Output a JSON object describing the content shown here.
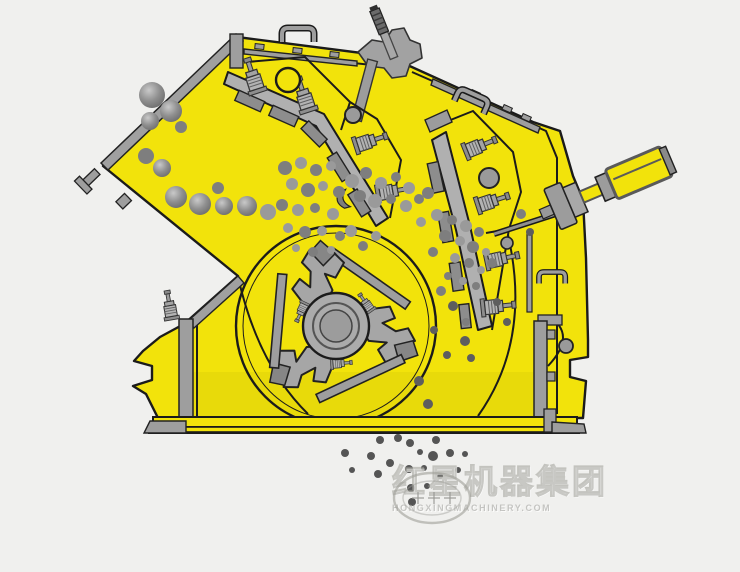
{
  "meta": {
    "alt": "Cutaway working-principle diagram of an impact crusher: rock is fed from the upper-left chute, struck by a three-hammer rotor, bounced against two spring-loaded apron plates, and discharged as crushed product below the base",
    "background": "#f0f0ee"
  },
  "colors": {
    "body_yellow": "#f2e30b",
    "outline_black": "#1b1b1b",
    "steel_gray": "#a6a6a6",
    "steel_dark": "#8a8a8a",
    "steel_light": "#c6c6c6",
    "rock_palette": [
      "#9a9a9a",
      "#7e7e7e",
      "#5e5e5e"
    ],
    "product_dot": "#555555",
    "watermark_gray": "#9e9e98"
  },
  "watermark": {
    "logo": "oval-globe-logo",
    "brand_cn": "红星机器集团",
    "brand_en": "HONGXINGMACHINERY.COM"
  },
  "figure": {
    "rocks": {
      "feed": [
        [
          152,
          95,
          13,
          0
        ],
        [
          171,
          111,
          11,
          1
        ],
        [
          150,
          121,
          9,
          0
        ],
        [
          146,
          156,
          8,
          1
        ],
        [
          162,
          168,
          9,
          0
        ],
        [
          181,
          127,
          6,
          1
        ],
        [
          176,
          197,
          11,
          0
        ],
        [
          200,
          204,
          11,
          1
        ],
        [
          224,
          206,
          9,
          0
        ],
        [
          247,
          206,
          10,
          1
        ],
        [
          268,
          212,
          8,
          0
        ],
        [
          218,
          188,
          6,
          1
        ]
      ],
      "shower": [
        [
          285,
          168,
          7,
          1
        ],
        [
          301,
          163,
          6,
          0
        ],
        [
          316,
          170,
          6,
          1
        ],
        [
          331,
          166,
          5,
          0
        ],
        [
          292,
          184,
          6,
          0
        ],
        [
          308,
          190,
          7,
          1
        ],
        [
          323,
          186,
          5,
          0
        ],
        [
          339,
          192,
          6,
          1
        ],
        [
          352,
          181,
          7,
          0
        ],
        [
          366,
          173,
          6,
          1
        ],
        [
          381,
          183,
          6,
          0
        ],
        [
          396,
          177,
          5,
          1
        ],
        [
          409,
          188,
          6,
          0
        ],
        [
          282,
          205,
          6,
          1
        ],
        [
          298,
          210,
          6,
          0
        ],
        [
          315,
          208,
          5,
          1
        ],
        [
          333,
          214,
          6,
          0
        ],
        [
          288,
          228,
          5,
          0
        ],
        [
          305,
          232,
          6,
          1
        ],
        [
          322,
          231,
          5,
          0
        ],
        [
          340,
          236,
          5,
          1
        ],
        [
          296,
          248,
          4,
          0
        ],
        [
          313,
          252,
          5,
          1
        ],
        [
          331,
          250,
          4,
          0
        ],
        [
          360,
          196,
          6,
          1
        ],
        [
          375,
          201,
          7,
          0
        ],
        [
          391,
          199,
          5,
          1
        ],
        [
          406,
          206,
          6,
          0
        ],
        [
          419,
          199,
          5,
          1
        ],
        [
          437,
          215,
          6,
          0
        ],
        [
          452,
          220,
          5,
          1
        ],
        [
          466,
          226,
          6,
          0
        ],
        [
          479,
          232,
          5,
          1
        ],
        [
          445,
          236,
          6,
          1
        ],
        [
          460,
          241,
          5,
          0
        ],
        [
          473,
          247,
          6,
          1
        ],
        [
          486,
          252,
          4,
          0
        ],
        [
          455,
          258,
          5,
          0
        ],
        [
          469,
          263,
          5,
          1
        ],
        [
          481,
          270,
          4,
          0
        ],
        [
          492,
          263,
          5,
          1
        ],
        [
          448,
          276,
          4,
          1
        ],
        [
          463,
          281,
          4,
          0
        ],
        [
          476,
          286,
          4,
          1
        ],
        [
          351,
          231,
          6,
          0
        ],
        [
          363,
          246,
          5,
          1
        ],
        [
          376,
          236,
          5,
          0
        ],
        [
          428,
          193,
          6,
          1
        ],
        [
          421,
          222,
          5,
          0
        ],
        [
          433,
          252,
          5,
          1
        ],
        [
          521,
          214,
          5,
          1
        ],
        [
          530,
          232,
          4,
          2
        ],
        [
          441,
          291,
          5,
          1
        ],
        [
          453,
          306,
          5,
          2
        ],
        [
          466,
          322,
          4,
          1
        ],
        [
          434,
          330,
          4,
          2
        ],
        [
          447,
          355,
          4,
          2
        ],
        [
          419,
          381,
          5,
          2
        ],
        [
          428,
          404,
          5,
          2
        ],
        [
          465,
          341,
          5,
          2
        ],
        [
          471,
          358,
          4,
          2
        ],
        [
          497,
          302,
          4,
          2
        ],
        [
          507,
          322,
          4,
          2
        ]
      ],
      "product": [
        [
          380,
          440,
          4
        ],
        [
          398,
          438,
          4
        ],
        [
          410,
          443,
          4
        ],
        [
          345,
          453,
          4
        ],
        [
          420,
          452,
          3
        ],
        [
          371,
          456,
          4
        ],
        [
          390,
          463,
          4
        ],
        [
          433,
          456,
          5
        ],
        [
          450,
          453,
          4
        ],
        [
          465,
          454,
          3
        ],
        [
          409,
          469,
          4
        ],
        [
          424,
          468,
          3
        ],
        [
          378,
          474,
          4
        ],
        [
          411,
          488,
          4
        ],
        [
          427,
          486,
          3
        ],
        [
          440,
          476,
          3
        ],
        [
          412,
          502,
          4
        ],
        [
          436,
          440,
          4
        ],
        [
          458,
          470,
          3
        ],
        [
          352,
          470,
          3
        ]
      ]
    }
  }
}
